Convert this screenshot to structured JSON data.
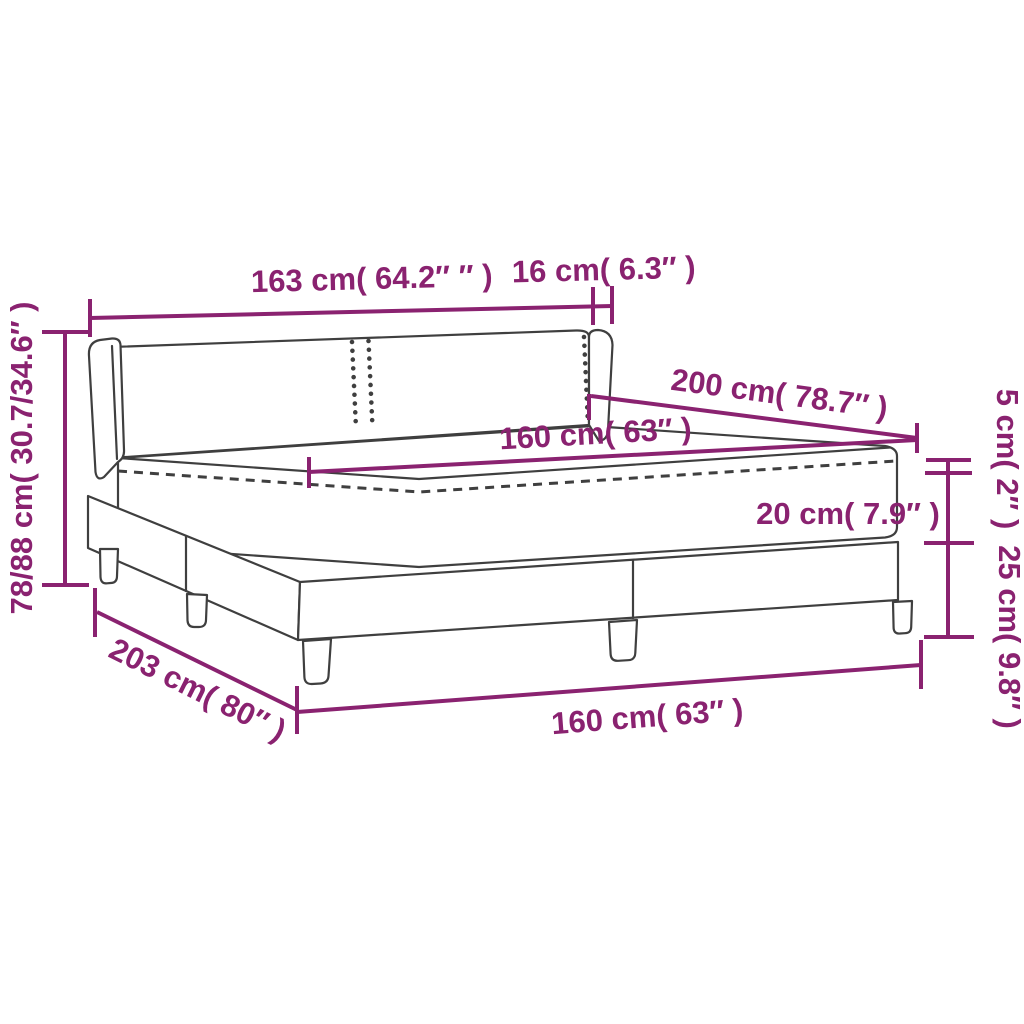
{
  "diagram": {
    "title": "Box spring bed with topper — dimension diagram",
    "background_color": "#ffffff",
    "outline_color": "#3f3f3f",
    "dimension_color": "#8a2270",
    "labels": {
      "headboard_width": "163 cm( 64.2″ ″ )",
      "headboard_depth": "16 cm( 6.3″ )",
      "total_height": "78/88 cm( 30.7/34.6″ )",
      "bed_length": "200 cm( 78.7″ )",
      "mattress_width": "160 cm( 63″ )",
      "topper_height": "5 cm( 2″ )",
      "mattress_height": "20 cm( 7.9″ )",
      "base_leg_height": "25 cm( 9.8″ )",
      "total_length": "203 cm( 80″ )",
      "base_width": "160 cm( 63″ )"
    }
  }
}
